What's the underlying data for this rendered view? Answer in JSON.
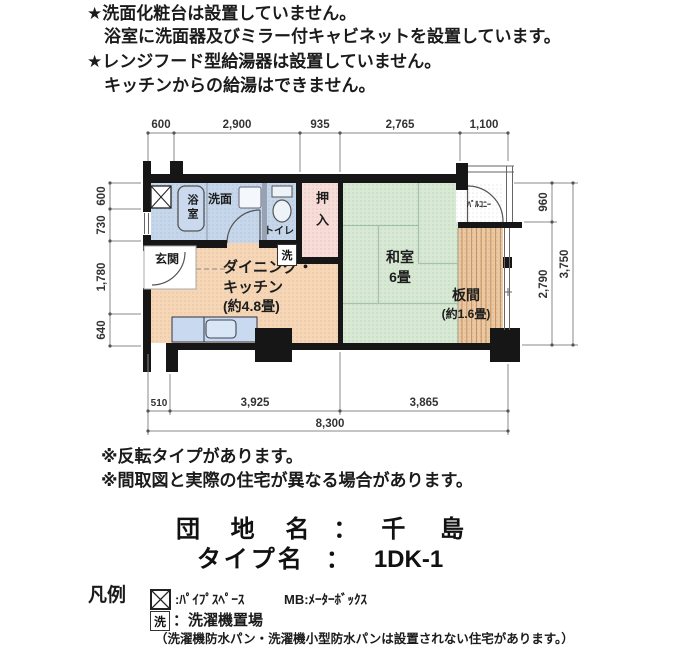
{
  "notes_top": [
    "★洗面化粧台は設置していません。",
    "浴室に洗面器及びミラー付キャビネットを設置しています。",
    "★レンジフード型給湯器は設置していません。",
    "キッチンからの給湯はできません。"
  ],
  "plan": {
    "rooms": {
      "bath": "浴室",
      "washroom": "洗面",
      "toilet": "トイレ",
      "closet": "押入",
      "washitsu_name": "和室",
      "washitsu_size": "6畳",
      "itanoma_name": "板間",
      "itanoma_size": "(約1.6畳)",
      "dk_line1": "ダイニング・",
      "dk_line2": "キッチン",
      "dk_size": "(約4.8畳)",
      "genkan": "玄関",
      "laundry_mark": "洗",
      "balcony": "ﾊﾞﾙｺﾆｰ"
    },
    "dims": {
      "top": [
        "600",
        "2,900",
        "935",
        "2,765",
        "1,100"
      ],
      "left": [
        "600",
        "730",
        "1,780",
        "640"
      ],
      "right": [
        "960",
        "2,790",
        "3,750"
      ],
      "bottom": [
        "510",
        "3,925",
        "3,865",
        "8,300"
      ]
    }
  },
  "notes_bottom": [
    "※反転タイプがあります。",
    "※間取図と実際の住宅が異なる場合があります。"
  ],
  "title": {
    "danchi_label": "団 地 名",
    "colon": "：",
    "danchi_value": "千 島",
    "type_label": "タイプ名",
    "type_value": "1DK-1"
  },
  "legend": {
    "heading": "凡例",
    "pipe_label": ":ﾊﾟｲﾌﾟｽﾍﾟｰｽ",
    "mb_label": "MB:ﾒｰﾀｰﾎﾞｯｸｽ",
    "laundry_symbol": "洗",
    "laundry_label": "：洗濯機置場",
    "note": "（洗濯機防水パン・洗濯機小型防水パンは設置されない住宅があります。）"
  },
  "colors": {
    "wall": "#161616",
    "water_blue": "#c6d7eb",
    "dk_peach": "#f6d6b5",
    "closet_pink": "#f8dcd7",
    "tatami_green": "#d7e9d3",
    "wood_tan": "#ecc9a2",
    "wood_stripe": "#c3925f",
    "dim_line": "#8a8a8a"
  }
}
